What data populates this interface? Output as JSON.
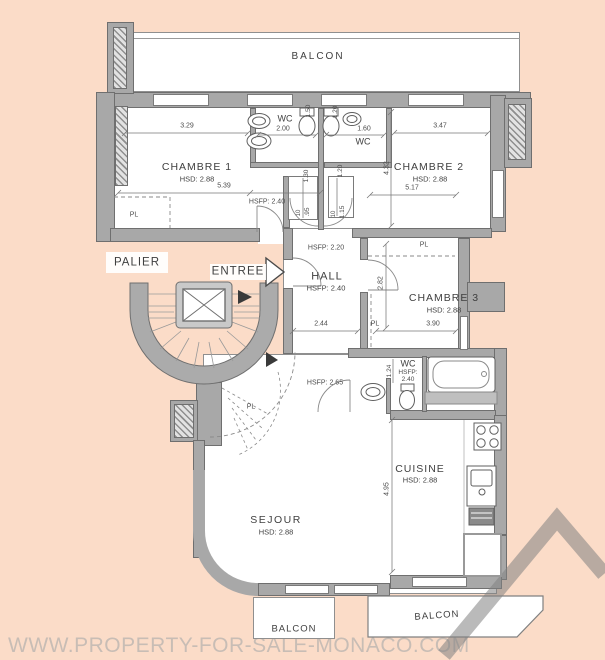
{
  "title": "Apartment floor plan",
  "watermark": "WWW.PROPERTY-FOR-SALE-MONACO.COM",
  "colors": {
    "background": "#fbdcc8",
    "wall": "#a8a8a8",
    "wall_outline": "#6f6f6f",
    "floor": "#ffffff",
    "text": "#3f3f3f",
    "watermark": "#c8bdb5",
    "logo": "#8d8d8d"
  },
  "balconies": {
    "top": "BALCON",
    "bottom_center": "BALCON",
    "bottom_right": "BALCON"
  },
  "landing": {
    "palier": "PALIER",
    "entree": "ENTREE"
  },
  "rooms": {
    "chambre1": {
      "name": "CHAMBRE 1",
      "hsd": "HSD: 2.88",
      "dim_width": "3.29",
      "dim_length": "5.39",
      "hsfp": "HSFP: 2.40",
      "closet": "PL"
    },
    "wc1": {
      "name": "WC",
      "dim_width": "2.00",
      "dim_shaft": "1.50"
    },
    "wc2": {
      "name": "WC",
      "dim_width": "1.60",
      "dim_depth": "1.20"
    },
    "chambre2": {
      "name": "CHAMBRE 2",
      "hsd": "HSD: 2.88",
      "dim_width": "3.47",
      "dim_length": "5.17",
      "dim_depth": "4.32",
      "closet": "PL"
    },
    "hall": {
      "name": "HALL",
      "hsfp": "HSFP: 2.40",
      "hsfp_entry": "HSFP: 2.20",
      "hsfp_under_stair": "HSFP: 2.65",
      "dim_width": "2.44"
    },
    "chambre3": {
      "name": "CHAMBRE 3",
      "hsd": "HSD: 2.88",
      "dim_width": "3.90",
      "dim_depth": "2.82",
      "closet": "PL"
    },
    "bathroom": {
      "name": "WC",
      "hsfp_label": "HSFP:",
      "hsfp_value": "2.40",
      "dim_width": "1.24"
    },
    "sejour": {
      "name": "SEJOUR",
      "hsd": "HSD: 2.88"
    },
    "cuisine": {
      "name": "CUISINE",
      "hsd": "HSD: 2.88",
      "dim_length": "4.95"
    },
    "stairs": {
      "closet": "PL"
    }
  },
  "door_dims": {
    "closet_left": "1.30",
    "closet_right": "1.20",
    "door_left_width": ".95",
    "door_left_offset": "10",
    "door_right_width": "1.15",
    "door_right_offset": "10"
  }
}
